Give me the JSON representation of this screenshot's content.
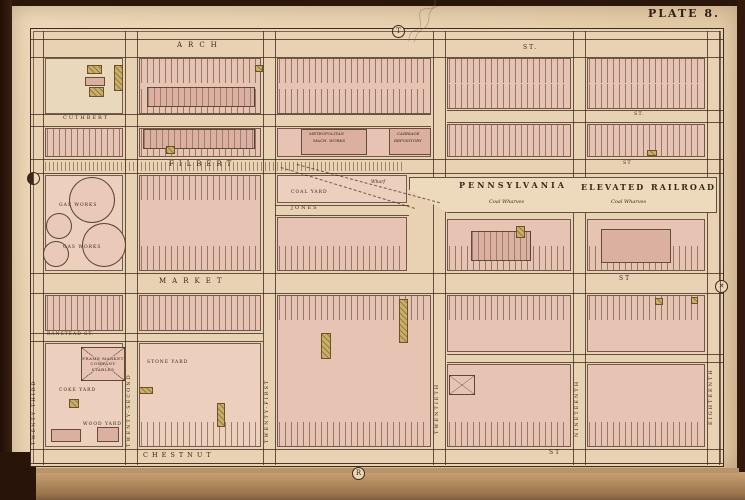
{
  "plate_label": "PLATE 8.",
  "palette": {
    "photo_frame": "#2b160b",
    "page_cream": "#e8d4b2",
    "map_paper": "#e9d2b3",
    "block_pink": "#e6c3b2",
    "building_pink": "#dcb0a0",
    "wood_frame_yellow": "#c9ae68",
    "ink_sepia": "#3a281a",
    "table_tan": "#c9a175"
  },
  "map": {
    "street_names_horizontal": [
      "ARCH",
      "CUTHBERT",
      "FILBERT",
      "JONES",
      "MARKET",
      "RANSTEAD",
      "CHESTNUT"
    ],
    "street_names_vertical": [
      "TWENTY-THIRD",
      "TWENTY-SECOND",
      "TWENTY-FIRST",
      "TWENTIETH",
      "NINETEENTH",
      "EIGHTEENTH"
    ],
    "railroad": {
      "name_1": "PENNSYLVANIA",
      "name_2": "ELEVATED RAILROAD",
      "annotation": "Coal Wharves"
    },
    "markers": [
      {
        "g": "T",
        "x": 391,
        "y": 24
      },
      {
        "g": "R",
        "x": 351,
        "y": 466
      },
      {
        "g": "",
        "x": 26,
        "y": 171,
        "f": 1
      },
      {
        "g": "✕",
        "x": 714,
        "y": 279
      }
    ],
    "hlines": [
      {
        "y": 38,
        "x1": 30,
        "x2": 722
      },
      {
        "y": 56,
        "x1": 30,
        "x2": 722
      },
      {
        "y": 113,
        "x1": 30,
        "x2": 430
      },
      {
        "y": 125,
        "x1": 30,
        "x2": 430
      },
      {
        "y": 109,
        "x1": 446,
        "x2": 722
      },
      {
        "y": 121,
        "x1": 446,
        "x2": 722
      },
      {
        "y": 158,
        "x1": 30,
        "x2": 722
      },
      {
        "y": 172,
        "x1": 30,
        "x2": 722
      },
      {
        "y": 204,
        "x1": 274,
        "x2": 408
      },
      {
        "y": 214,
        "x1": 274,
        "x2": 408
      },
      {
        "y": 272,
        "x1": 30,
        "x2": 722
      },
      {
        "y": 292,
        "x1": 30,
        "x2": 722
      },
      {
        "y": 332,
        "x1": 30,
        "x2": 262
      },
      {
        "y": 340,
        "x1": 30,
        "x2": 262
      },
      {
        "y": 353,
        "x1": 446,
        "x2": 722
      },
      {
        "y": 361,
        "x1": 446,
        "x2": 722
      },
      {
        "y": 448,
        "x1": 30,
        "x2": 722
      },
      {
        "y": 462,
        "x1": 30,
        "x2": 722
      }
    ],
    "vlines": [
      {
        "x": 42,
        "y1": 30,
        "y2": 464
      },
      {
        "x": 124,
        "y1": 30,
        "y2": 464
      },
      {
        "x": 136,
        "y1": 30,
        "y2": 464
      },
      {
        "x": 262,
        "y1": 30,
        "y2": 464
      },
      {
        "x": 274,
        "y1": 30,
        "y2": 464
      },
      {
        "x": 432,
        "y1": 30,
        "y2": 464
      },
      {
        "x": 444,
        "y1": 30,
        "y2": 464
      },
      {
        "x": 572,
        "y1": 30,
        "y2": 464
      },
      {
        "x": 584,
        "y1": 30,
        "y2": 464
      },
      {
        "x": 706,
        "y1": 30,
        "y2": 464
      },
      {
        "x": 718,
        "y1": 30,
        "y2": 464
      }
    ],
    "blocks": [
      {
        "x": 44,
        "y": 57,
        "w": 78,
        "h": 56,
        "tint": "open",
        "rows": ""
      },
      {
        "x": 138,
        "y": 57,
        "w": 122,
        "h": 56,
        "rows": "tb"
      },
      {
        "x": 276,
        "y": 57,
        "w": 154,
        "h": 56,
        "rows": "tb"
      },
      {
        "x": 446,
        "y": 57,
        "w": 124,
        "h": 51,
        "rows": "tb"
      },
      {
        "x": 586,
        "y": 57,
        "w": 118,
        "h": 51,
        "rows": "tb"
      },
      {
        "x": 44,
        "y": 127,
        "w": 78,
        "h": 29,
        "rows": "b"
      },
      {
        "x": 138,
        "y": 127,
        "w": 122,
        "h": 29,
        "rows": "b"
      },
      {
        "x": 276,
        "y": 127,
        "w": 154,
        "h": 29,
        "rows": ""
      },
      {
        "x": 446,
        "y": 123,
        "w": 124,
        "h": 33,
        "rows": "b"
      },
      {
        "x": 586,
        "y": 123,
        "w": 118,
        "h": 33,
        "rows": "b"
      },
      {
        "x": 44,
        "y": 174,
        "w": 78,
        "h": 96,
        "tint": "pale",
        "rows": ""
      },
      {
        "x": 138,
        "y": 174,
        "w": 122,
        "h": 96,
        "rows": "tb"
      },
      {
        "x": 276,
        "y": 174,
        "w": 130,
        "h": 28,
        "tint": "pale",
        "rows": ""
      },
      {
        "x": 276,
        "y": 216,
        "w": 130,
        "h": 54,
        "rows": "b"
      },
      {
        "x": 446,
        "y": 218,
        "w": 124,
        "h": 52,
        "rows": "b"
      },
      {
        "x": 586,
        "y": 218,
        "w": 118,
        "h": 52,
        "rows": "b"
      },
      {
        "x": 44,
        "y": 294,
        "w": 78,
        "h": 36,
        "rows": "t"
      },
      {
        "x": 138,
        "y": 294,
        "w": 122,
        "h": 36,
        "rows": "t"
      },
      {
        "x": 44,
        "y": 342,
        "w": 78,
        "h": 104,
        "tint": "pale",
        "rows": ""
      },
      {
        "x": 138,
        "y": 342,
        "w": 122,
        "h": 104,
        "tint": "pale",
        "rows": "b"
      },
      {
        "x": 276,
        "y": 294,
        "w": 154,
        "h": 152,
        "rows": "tb"
      },
      {
        "x": 446,
        "y": 294,
        "w": 124,
        "h": 57,
        "rows": "t"
      },
      {
        "x": 446,
        "y": 363,
        "w": 124,
        "h": 83,
        "rows": "b"
      },
      {
        "x": 586,
        "y": 294,
        "w": 118,
        "h": 57,
        "rows": "t"
      },
      {
        "x": 586,
        "y": 363,
        "w": 118,
        "h": 83,
        "rows": "b"
      }
    ],
    "rr_band": {
      "x": 408,
      "y": 176,
      "w": 308,
      "h": 36
    },
    "filbert_track": {
      "x": 44,
      "y": 161,
      "w": 360,
      "h": 9
    },
    "spur_tracks": [
      {
        "x": 280,
        "y": 166,
        "len": 140,
        "rot": 17
      },
      {
        "x": 296,
        "y": 163,
        "len": 148,
        "rot": 15
      }
    ],
    "buildings": [
      {
        "x": 146,
        "y": 86,
        "w": 108,
        "h": 20,
        "striped": true
      },
      {
        "x": 142,
        "y": 128,
        "w": 112,
        "h": 20,
        "striped": true
      },
      {
        "x": 300,
        "y": 128,
        "w": 66,
        "h": 26
      },
      {
        "x": 388,
        "y": 127,
        "w": 42,
        "h": 27
      },
      {
        "x": 470,
        "y": 230,
        "w": 60,
        "h": 30,
        "striped": true
      },
      {
        "x": 600,
        "y": 228,
        "w": 70,
        "h": 34
      },
      {
        "x": 84,
        "y": 76,
        "w": 20,
        "h": 9
      },
      {
        "x": 50,
        "y": 428,
        "w": 30,
        "h": 13
      },
      {
        "x": 96,
        "y": 426,
        "w": 22,
        "h": 15
      }
    ],
    "yellow_buildings": [
      {
        "x": 86,
        "y": 64,
        "w": 15,
        "h": 9
      },
      {
        "x": 88,
        "y": 86,
        "w": 15,
        "h": 10
      },
      {
        "x": 113,
        "y": 64,
        "w": 9,
        "h": 26
      },
      {
        "x": 254,
        "y": 64,
        "w": 8,
        "h": 7
      },
      {
        "x": 165,
        "y": 145,
        "w": 9,
        "h": 8
      },
      {
        "x": 646,
        "y": 149,
        "w": 10,
        "h": 6
      },
      {
        "x": 515,
        "y": 225,
        "w": 9,
        "h": 12
      },
      {
        "x": 320,
        "y": 332,
        "w": 10,
        "h": 26
      },
      {
        "x": 398,
        "y": 298,
        "w": 9,
        "h": 44
      },
      {
        "x": 138,
        "y": 386,
        "w": 14,
        "h": 7
      },
      {
        "x": 216,
        "y": 402,
        "w": 8,
        "h": 24
      },
      {
        "x": 68,
        "y": 398,
        "w": 10,
        "h": 9
      },
      {
        "x": 654,
        "y": 297,
        "w": 8,
        "h": 7
      },
      {
        "x": 690,
        "y": 296,
        "w": 7,
        "h": 7
      }
    ],
    "gas_circles": [
      {
        "cx": 90,
        "cy": 198,
        "r": 22
      },
      {
        "cx": 102,
        "cy": 243,
        "r": 21
      },
      {
        "cx": 57,
        "cy": 224,
        "r": 12
      },
      {
        "cx": 54,
        "cy": 252,
        "r": 12
      }
    ],
    "x_buildings": [
      {
        "x": 80,
        "y": 346,
        "w": 44,
        "h": 34,
        "lines": [
          "FRAME MARKET",
          "COMPANY",
          "STABLES"
        ]
      },
      {
        "x": 448,
        "y": 374,
        "w": 26,
        "h": 20,
        "lines": []
      }
    ],
    "labels": [
      {
        "t": "ARCH",
        "x": 176,
        "y": 41,
        "fs": 7,
        "ls": 6
      },
      {
        "t": "ST.",
        "x": 522,
        "y": 44,
        "fs": 6,
        "ls": 2
      },
      {
        "t": "CUTHBERT",
        "x": 62,
        "y": 115,
        "fs": 5,
        "ls": 2
      },
      {
        "t": "ST.",
        "x": 633,
        "y": 111,
        "fs": 5,
        "ls": 1
      },
      {
        "t": "FILBERT",
        "x": 168,
        "y": 160,
        "fs": 7,
        "ls": 5
      },
      {
        "t": "ST",
        "x": 622,
        "y": 160,
        "fs": 5,
        "ls": 1
      },
      {
        "t": "JONES",
        "x": 290,
        "y": 205,
        "fs": 5,
        "ls": 2
      },
      {
        "t": "MARKET",
        "x": 158,
        "y": 277,
        "fs": 7,
        "ls": 6
      },
      {
        "t": "ST",
        "x": 618,
        "y": 275,
        "fs": 6,
        "ls": 2
      },
      {
        "t": "RANSTEAD ST.",
        "x": 46,
        "y": 332,
        "fs": 4.5,
        "ls": 1
      },
      {
        "t": "CHESTNUT",
        "x": 142,
        "y": 451,
        "fs": 6.5,
        "ls": 4
      },
      {
        "t": "ST",
        "x": 548,
        "y": 449,
        "fs": 6,
        "ls": 2
      },
      {
        "t": "PENNSYLVANIA",
        "x": 458,
        "y": 180,
        "fs": 8,
        "ls": 3,
        "b": 1
      },
      {
        "t": "ELEVATED",
        "x": 580,
        "y": 182,
        "fs": 8,
        "ls": 2,
        "b": 1
      },
      {
        "t": "RAILROAD",
        "x": 650,
        "y": 182,
        "fs": 8,
        "ls": 2,
        "b": 1
      },
      {
        "t": "Coal Wharves",
        "x": 488,
        "y": 199,
        "fs": 5,
        "it": 1
      },
      {
        "t": "Coal Wharves",
        "x": 610,
        "y": 199,
        "fs": 5,
        "it": 1
      },
      {
        "t": "Wharf",
        "x": 370,
        "y": 180,
        "fs": 4.5,
        "it": 1
      },
      {
        "t": "COAL YARD",
        "x": 290,
        "y": 190,
        "fs": 4.5,
        "ls": 1
      },
      {
        "t": "GAS WORKS",
        "x": 58,
        "y": 203,
        "fs": 4.5,
        "ls": 1
      },
      {
        "t": "GAS WORKS",
        "x": 62,
        "y": 245,
        "fs": 4.5,
        "ls": 1
      },
      {
        "t": "STONE YARD",
        "x": 146,
        "y": 360,
        "fs": 4.5,
        "ls": 1
      },
      {
        "t": "COKE YARD",
        "x": 58,
        "y": 388,
        "fs": 4.5,
        "ls": 1
      },
      {
        "t": "WOOD YARD",
        "x": 82,
        "y": 422,
        "fs": 4.5,
        "ls": 1
      },
      {
        "t": "METROPOLITAN",
        "x": 308,
        "y": 131,
        "fs": 4,
        "it": 1
      },
      {
        "t": "MACH. WORKS",
        "x": 312,
        "y": 138,
        "fs": 4,
        "it": 1
      },
      {
        "t": "CARRIAGE",
        "x": 396,
        "y": 131,
        "fs": 4,
        "it": 1
      },
      {
        "t": "REPOSITORY",
        "x": 393,
        "y": 138,
        "fs": 4,
        "it": 1
      }
    ],
    "vstreet_labels": [
      {
        "t": "TWENTY-THIRD",
        "x": 31,
        "y": 352,
        "h": 92
      },
      {
        "t": "TWENTY-SECOND",
        "x": 126,
        "y": 346,
        "h": 100
      },
      {
        "t": "TWENTY-FIRST",
        "x": 264,
        "y": 350,
        "h": 92
      },
      {
        "t": "TWENTIETH",
        "x": 434,
        "y": 355,
        "h": 78
      },
      {
        "t": "NINETEENTH",
        "x": 574,
        "y": 352,
        "h": 84
      },
      {
        "t": "EIGHTEENTH",
        "x": 708,
        "y": 338,
        "h": 86
      }
    ]
  }
}
